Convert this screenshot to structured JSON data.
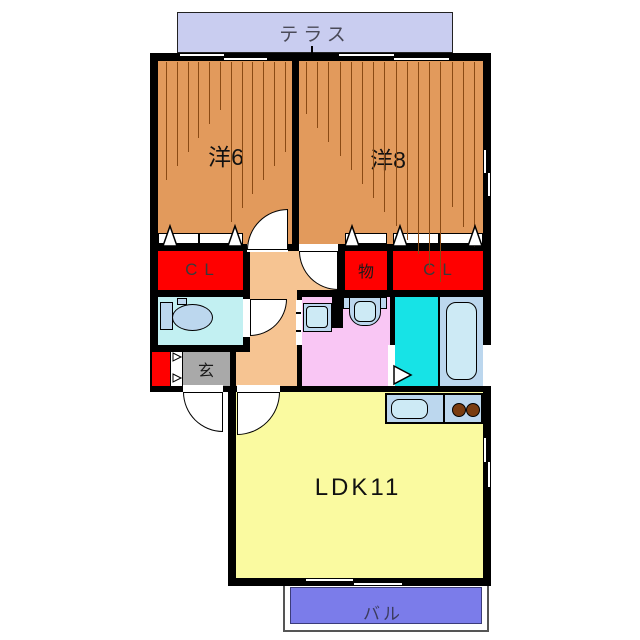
{
  "plan": {
    "terrace_label": "テラス",
    "room_west6_label": "洋6",
    "room_west8_label": "洋8",
    "closet_left_label": "CL",
    "storage_label": "物",
    "closet_right_label": "CL",
    "entrance_label": "玄",
    "ldk_label": "LDK11",
    "balcony_label": "バル"
  },
  "colors": {
    "wall": "#000000",
    "wood_room": "#e29a5c",
    "hallway": "#f6c492",
    "closet": "#ff0000",
    "terrace": "#c9cdf0",
    "balcony": "#7b7cea",
    "ldk": "#fafaa0",
    "entrance": "#a9a9a9",
    "toilet_room": "#c2f0f2",
    "washroom": "#f9c6f4",
    "bathroom": "#17e3e6",
    "fixture": "#bcd7ee",
    "fixture_light": "#cdeaf5",
    "burner": "#7a3c10",
    "hatch": "#8a4a14"
  }
}
